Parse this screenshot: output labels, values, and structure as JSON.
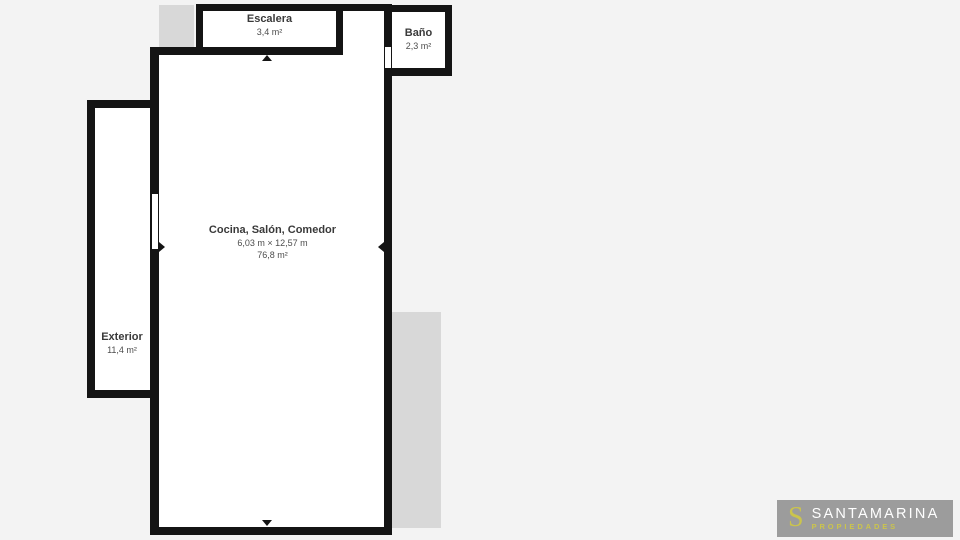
{
  "plan": {
    "rooms": {
      "escalera": {
        "name": "Escalera",
        "area": "3,4 m²"
      },
      "bano": {
        "name": "Baño",
        "area": "2,3 m²"
      },
      "main": {
        "name": "Cocina, Salón, Comedor",
        "dimensions": "6,03 m × 12,57 m",
        "area": "76,8 m²"
      },
      "exterior": {
        "name": "Exterior",
        "area": "11,4 m²"
      }
    }
  },
  "logo": {
    "initial": "S",
    "brand": "SANTAMARINA",
    "tagline": "PROPIEDADES"
  },
  "colors": {
    "background": "#f3f3f3",
    "wall": "#141414",
    "room_fill": "#ffffff",
    "shadow_gray": "#d8d8d8",
    "logo_background": "#9c9c9c",
    "logo_accent": "#cbc44c",
    "logo_text": "#ffffff",
    "label_text": "#3a3a3a"
  }
}
